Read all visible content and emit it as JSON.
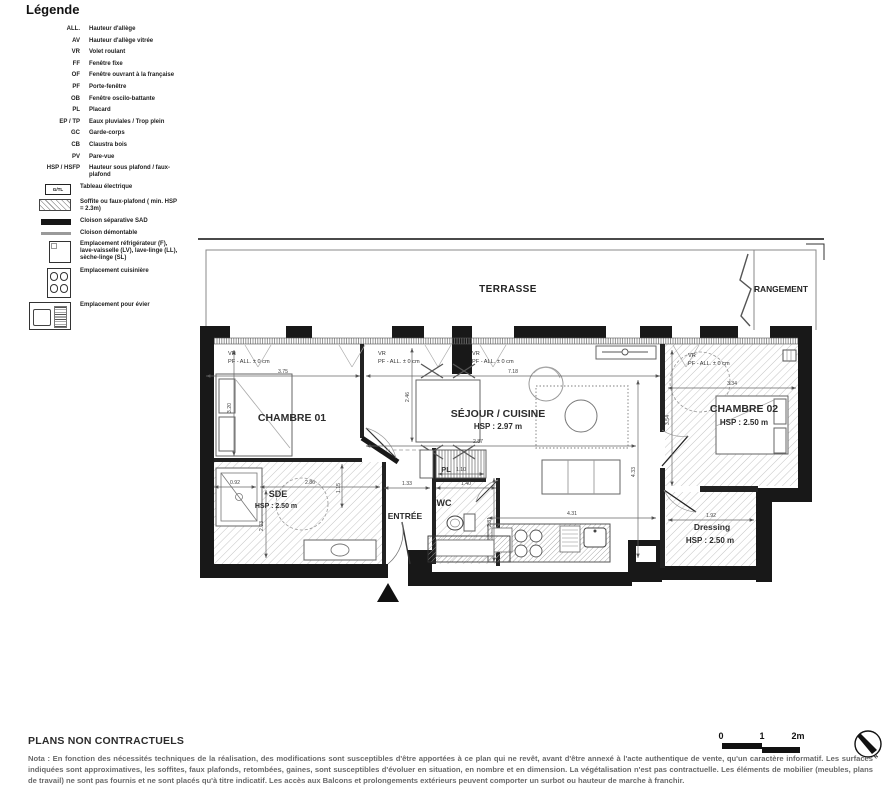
{
  "legend": {
    "title": "Légende",
    "abbrev_items": [
      {
        "abbr": "ALL.",
        "label": "Hauteur d'allège"
      },
      {
        "abbr": "AV",
        "label": "Hauteur d'allège vitrée"
      },
      {
        "abbr": "VR",
        "label": "Volet roulant"
      },
      {
        "abbr": "FF",
        "label": "Fenêtre fixe"
      },
      {
        "abbr": "OF",
        "label": "Fenêtre ouvrant à la française"
      },
      {
        "abbr": "PF",
        "label": "Porte-fenêtre"
      },
      {
        "abbr": "OB",
        "label": "Fenêtre oscilo-battante"
      },
      {
        "abbr": "PL",
        "label": "Placard"
      },
      {
        "abbr": "EP / TP",
        "label": "Eaux pluviales / Trop plein"
      },
      {
        "abbr": "GC",
        "label": "Garde-corps"
      },
      {
        "abbr": "CB",
        "label": "Claustra bois"
      },
      {
        "abbr": "PV",
        "label": "Pare-vue"
      },
      {
        "abbr": "HSP / HSFP",
        "label": "Hauteur sous plafond / faux-plafond"
      }
    ],
    "symbol_items": [
      {
        "icon": "gtl-box",
        "icon_text": "G/TL",
        "label": "Tableau électrique"
      },
      {
        "icon": "soffit-hatch-swatch",
        "label": "Soffite ou faux-plafond ( min. HSP = 2.3m)"
      },
      {
        "icon": "sad-partition-swatch",
        "label": "Cloison séparative SAD"
      },
      {
        "icon": "demountable-partition-swatch",
        "label": "Cloison démontable"
      },
      {
        "icon": "appliance-slot",
        "label": "Emplacement réfrigérateur (F), lave-vaisselle (LV), lave-linge (LL), sèche-linge (SL)"
      },
      {
        "icon": "cooker-slot",
        "label": "Emplacement cuisinière"
      },
      {
        "icon": "sink-slot",
        "label": "Emplacement pour évier"
      }
    ]
  },
  "plan": {
    "rooms": {
      "terrasse": {
        "name": "TERRASSE"
      },
      "rangement": {
        "name": "RANGEMENT"
      },
      "chambre01": {
        "name": "CHAMBRE 01"
      },
      "sejour_cuisine": {
        "name": "SÉJOUR / CUISINE",
        "hsp": "HSP : 2.97 m"
      },
      "chambre02": {
        "name": "CHAMBRE 02",
        "hsp": "HSP : 2.50 m"
      },
      "sde": {
        "name": "SDE",
        "hsp": "HSP : 2.50 m"
      },
      "entree": {
        "name": "ENTRÉE"
      },
      "wc": {
        "name": "WC"
      },
      "dressing": {
        "name": "Dressing",
        "hsp": "HSP : 2.50 m"
      },
      "placard": {
        "name": "PL"
      }
    },
    "window_labels": [
      {
        "line1": "VR",
        "line2": "PF - ALL. ± 0 cm"
      },
      {
        "line1": "VR",
        "line2": "PF - ALL. ± 0 cm"
      },
      {
        "line1": "VR",
        "line2": "PF - ALL. ± 0 cm"
      },
      {
        "line1": "VR",
        "line2": "PF - ALL. ± 0 cm"
      }
    ],
    "dims": {
      "d375": "3.75",
      "d718": "7.18",
      "d334": "3.34",
      "d320": "3.20",
      "d246": "2.46",
      "d287": "2.87",
      "d433": "4.33",
      "d354": "3.54",
      "d092": "0.92",
      "d286": "2.86",
      "d133": "1.33",
      "d140": "1.40",
      "d110": "1.10",
      "d115": "1.15",
      "d203": "2.03",
      "d281": "2.81",
      "d431": "4.31",
      "d192": "1.92"
    }
  },
  "footer": {
    "plans_title": "PLANS NON CONTRACTUELS",
    "nota": "Nota : En fonction des nécessités techniques de la réalisation, des modifications sont susceptibles d'être apportées à ce plan qui ne revêt, avant d'être annexé à l'acte authentique de vente, qu'un caractère informatif. Les surfaces indiquées sont approximatives, les soffites, faux plafonds, retombées, gaines, sont susceptibles d'évoluer en situation, en nombre et en dimension. La végétalisation n'est pas contractuelle. Les éléments de mobilier (meubles, plans de travail) ne sont pas fournis et ne sont placés qu'à titre indicatif. Les accès aux Balcons et prolongements extérieurs peuvent comporter un surbot ou hauteur de marche à franchir.",
    "scale_bar": {
      "tick0": "0",
      "tick1": "1",
      "tick2": "2m"
    },
    "north_label": "N"
  }
}
